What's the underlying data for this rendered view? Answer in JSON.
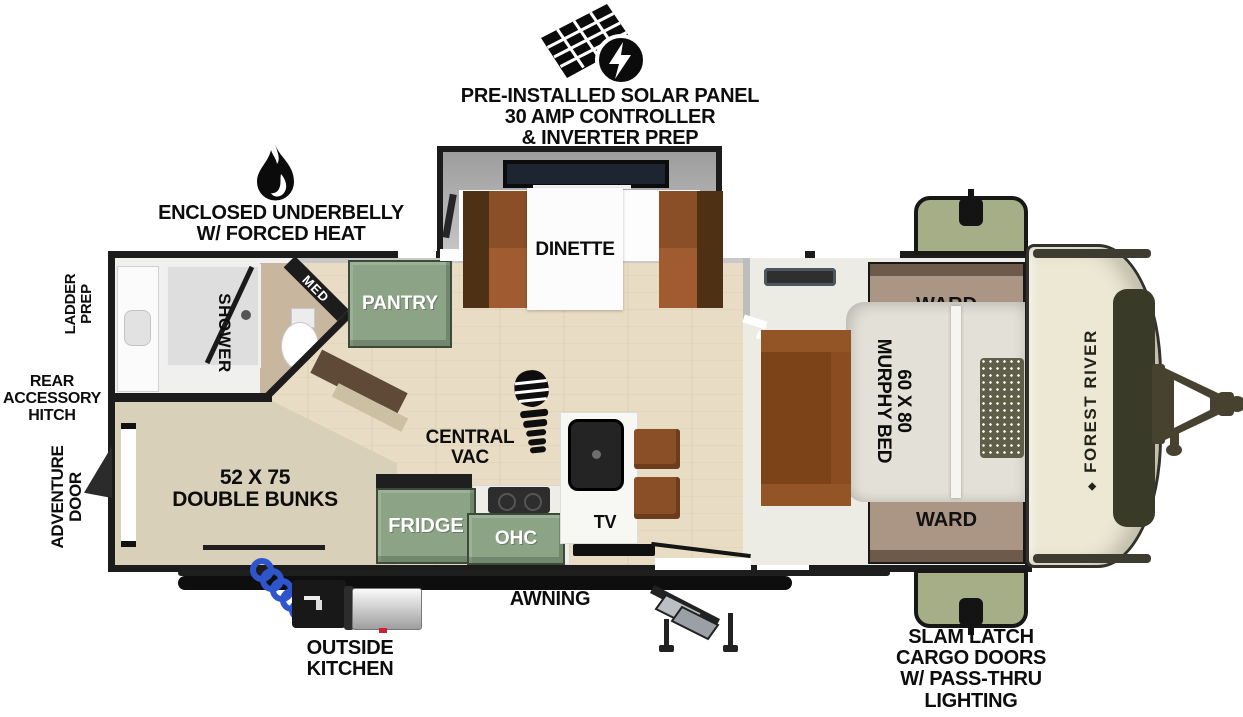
{
  "labels": {
    "solar": [
      "PRE-INSTALLED SOLAR PANEL",
      "30 AMP CONTROLLER",
      "& INVERTER PREP"
    ],
    "underbelly": [
      "ENCLOSED UNDERBELLY",
      "W/ FORCED HEAT"
    ],
    "ladder_prep": [
      "LADDER",
      "PREP"
    ],
    "rear_hitch": [
      "REAR",
      "ACCESSORY",
      "HITCH"
    ],
    "adventure_door": [
      "ADVENTURE",
      "DOOR"
    ],
    "awning": "AWNING",
    "outside_kitchen": [
      "OUTSIDE",
      "KITCHEN"
    ],
    "slam_latch": [
      "SLAM LATCH",
      "CARGO DOORS",
      "W/ PASS-THRU",
      "LIGHTING"
    ],
    "dinette": "DINETTE",
    "shower": "SHOWER",
    "med": "MED",
    "pantry": "PANTRY",
    "central_vac": [
      "CENTRAL",
      "VAC"
    ],
    "bunks": [
      "52 X 75",
      "DOUBLE BUNKS"
    ],
    "fridge": "FRIDGE",
    "ohc": "OHC",
    "tv": "TV",
    "ward": "WARD",
    "murphy_bed": [
      "60 X 80",
      "MURPHY BED"
    ],
    "brand": "FOREST RIVER",
    "brand_logo": "◆"
  },
  "colors": {
    "wall": "#1c1c1c",
    "wood_floor": "#e8ddc4",
    "bunk_floor": "#d9d0ba",
    "bedroom_floor": "#edece4",
    "cabinet_green": "#8ca386",
    "cargo_green": "#a6ae88",
    "ward_brown": "#ab9584",
    "bench_brown": "#8a4f26",
    "sofa_brown": "#7c4319",
    "cap_cream": "#ece8d4",
    "cap_window": "#3a3a29",
    "hose_blue": "#2f55cc"
  }
}
